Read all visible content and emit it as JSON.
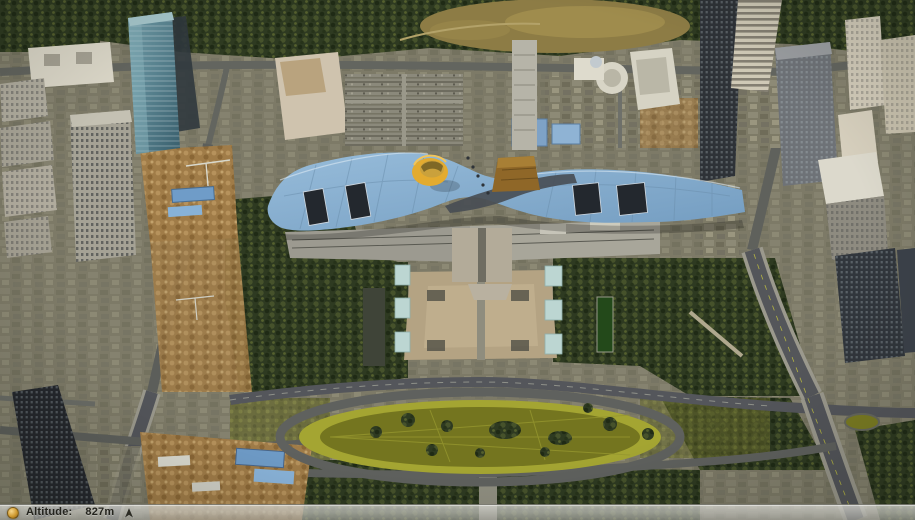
{
  "status_bar": {
    "stream_icon_name": "globe-status-icon",
    "altitude_label": "Altitude:",
    "altitude_value": "827m",
    "compass_icon_name": "north-arrow-icon"
  },
  "map_colors": {
    "civic_roof_light": "#97bcda",
    "civic_roof_dark": "#739cc0",
    "roof_cylinder_yellow": "#e3ab2f",
    "roof_structure_brown": "#8f6728",
    "plaza_tan": "#b4a383",
    "oval_lawn": "#74751f",
    "oval_ring_grass": "#a4a532",
    "tree_canopy": "#2e3a21",
    "road_gray": "#5b5d5a",
    "status_text": "#24241e"
  }
}
